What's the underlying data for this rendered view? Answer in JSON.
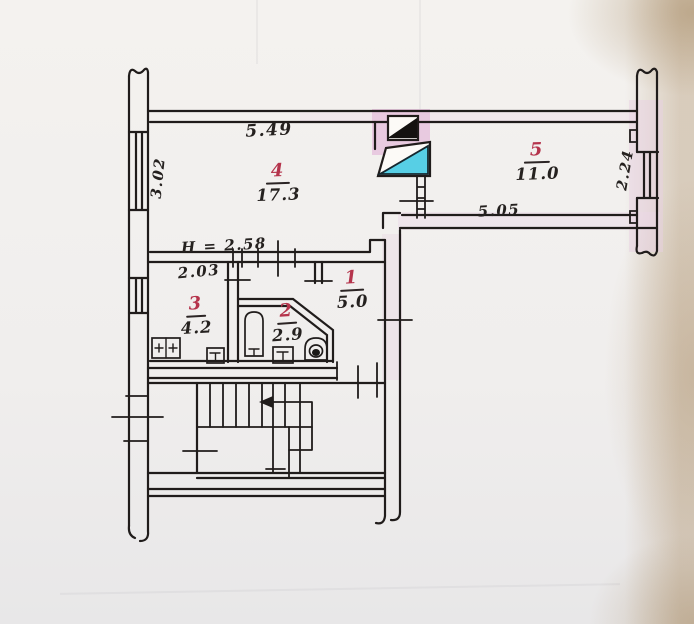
{
  "plan": {
    "title_hint": "hand-drawn apartment floor plan",
    "rooms": [
      {
        "number": "4",
        "area": "17.3"
      },
      {
        "number": "5",
        "area": "11.0"
      },
      {
        "number": "1",
        "area": "5.0"
      },
      {
        "number": "3",
        "area": "4.2"
      },
      {
        "number": "2",
        "area": "2.9"
      }
    ],
    "dimensions": {
      "room4_width": "5.49",
      "room4_left_height": "3.02",
      "ceiling_height": "H = 2.58",
      "room3_width": "2.03",
      "room5_width": "5.05",
      "room5_right_height": "2.24"
    },
    "fixtures": [
      "kitchen-stove",
      "kitchen-sink",
      "bathtub",
      "washbasin",
      "toilet",
      "staircase",
      "direction-arrow-icon",
      "window",
      "vent-shaft"
    ],
    "colors": {
      "ink": "#201c1b",
      "room_number_red": "#b5344c",
      "vent_cyan": "#57cfe5",
      "wall_highlight_pink": "#eacde1",
      "paper": "#f2f0ed",
      "paper_edge_beige": "#c2ad92"
    }
  }
}
